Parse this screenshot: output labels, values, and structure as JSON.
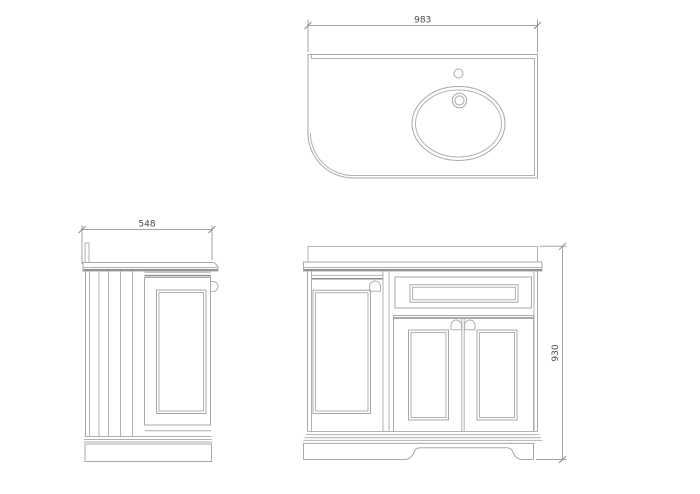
{
  "drawing": {
    "dimensions": {
      "top_width": "983",
      "side_depth": "548",
      "front_height": "930"
    },
    "colors": {
      "background": "#ffffff",
      "outline": "#b2b2b2",
      "outline_strong": "#8d8d8d",
      "dimension_line": "#a3a3a3",
      "dimension_text": "#4b4b4b"
    }
  }
}
